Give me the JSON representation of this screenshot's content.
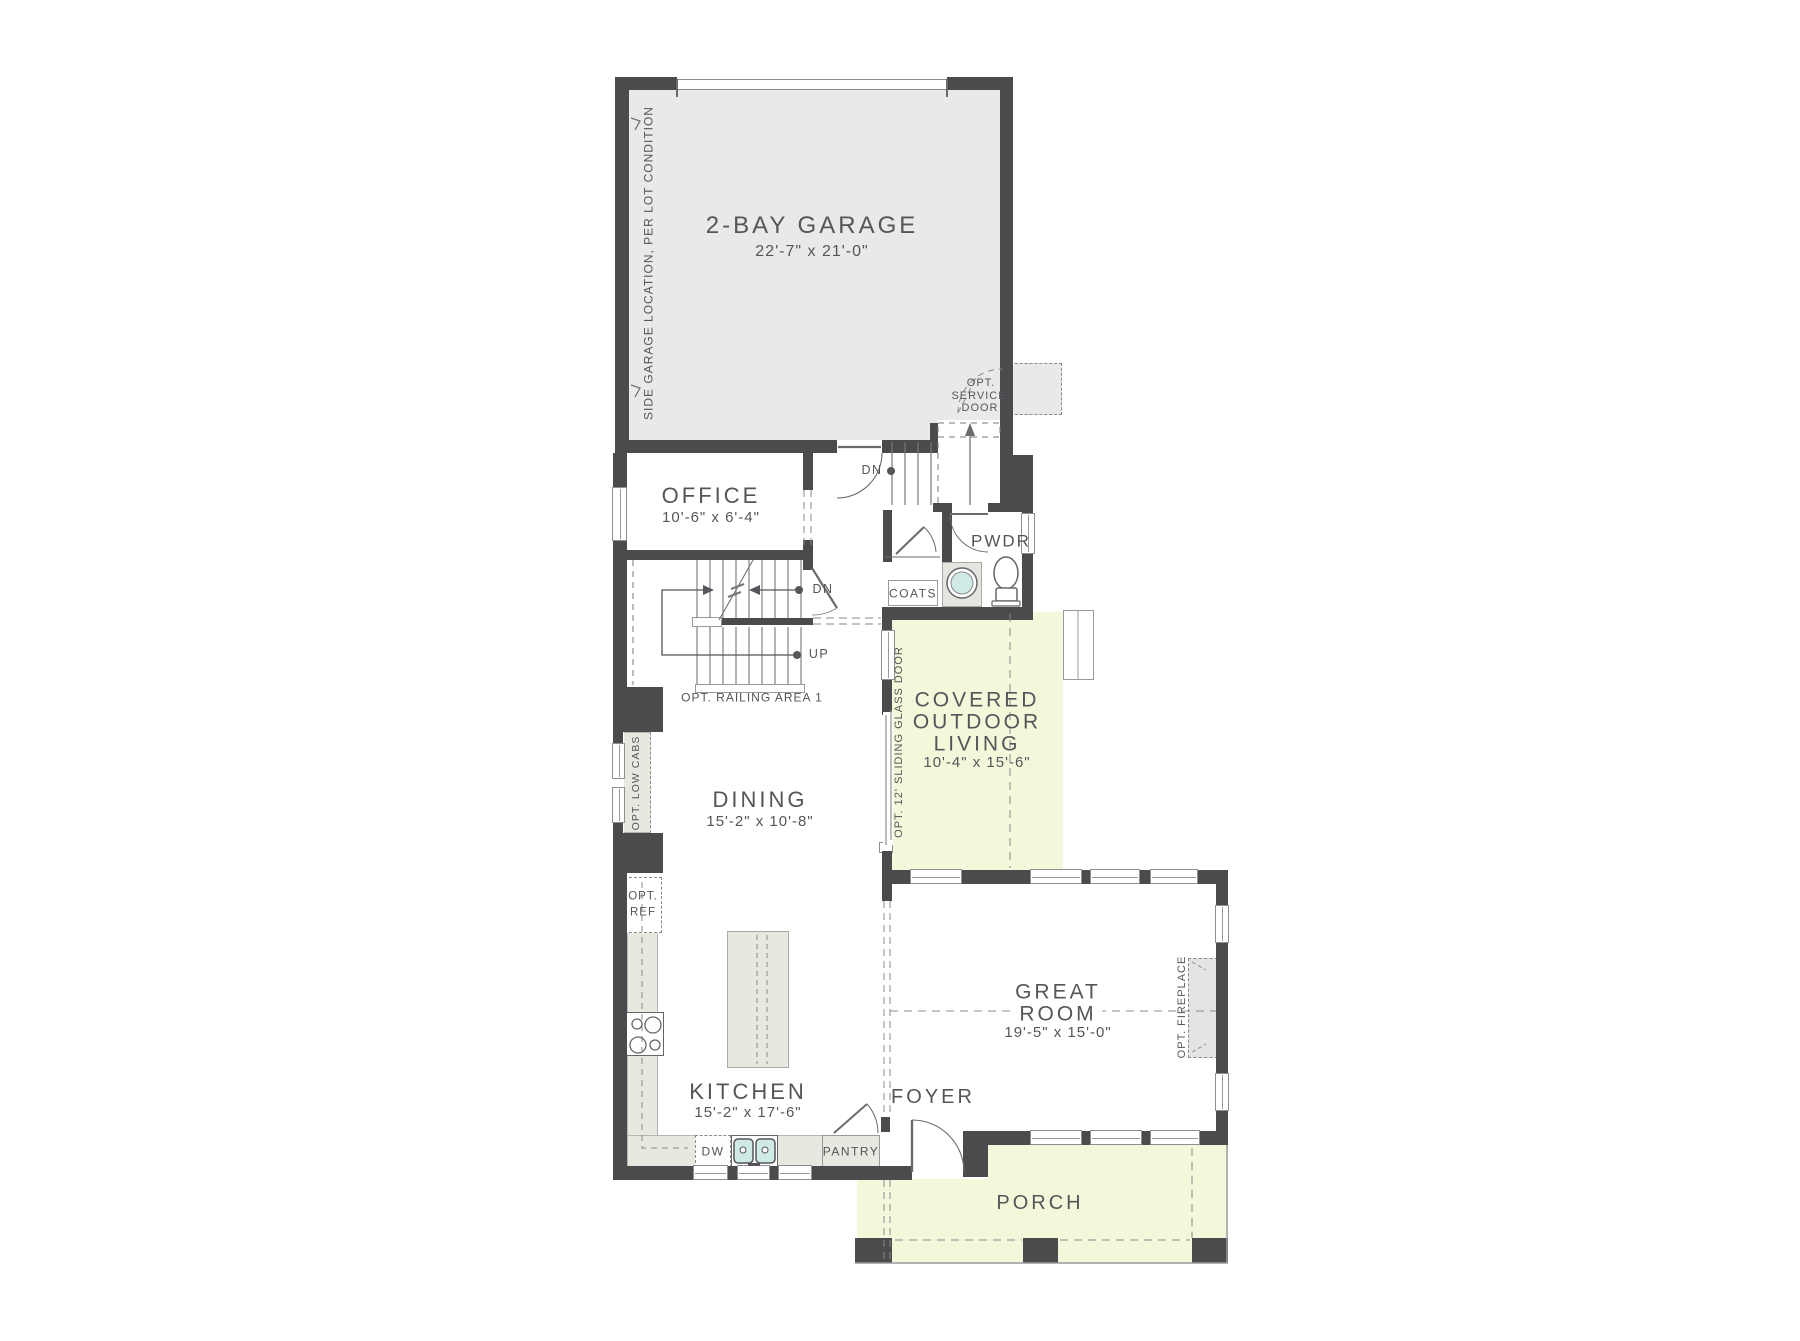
{
  "colors": {
    "wall": "#4b4b4d",
    "ink": "#55555a",
    "garage": "#e9e9e9",
    "outdoor": "#f5f7da",
    "counter": "#e8e7e0",
    "sink": "#cfe9e4",
    "fireplace": "#e4e4e4",
    "line": "#6b6b6e"
  },
  "rooms": {
    "garage": {
      "label": "2-BAY GARAGE",
      "dims": "22'-7\" x 21'-0\""
    },
    "office": {
      "label": "OFFICE",
      "dims": "10'-6\" x 6'-4\""
    },
    "dining": {
      "label": "DINING",
      "dims": "15'-2\" x 10'-8\""
    },
    "kitchen": {
      "label": "KITCHEN",
      "dims": "15'-2\" x 17'-6\""
    },
    "great_room": {
      "l1": "GREAT",
      "l2": "ROOM",
      "dims": "19'-5\" x 15'-0\""
    },
    "outdoor": {
      "l1": "COVERED",
      "l2": "OUTDOOR",
      "l3": "LIVING",
      "dims": "10'-4\" x 15'-6\""
    },
    "foyer": {
      "label": "FOYER"
    },
    "porch": {
      "label": "PORCH"
    },
    "pwdr": {
      "label": "PWDR"
    },
    "coats": {
      "label": "COATS"
    },
    "pantry": {
      "label": "PANTRY"
    }
  },
  "annotations": {
    "side_garage": "SIDE GARAGE LOCATION, PER LOT CONDITION",
    "opt_service_l1": "OPT.",
    "opt_service_l2": "SERVICE",
    "opt_service_l3": "DOOR",
    "opt_railing": "OPT. RAILING AREA 1",
    "opt_low_cabs": "OPT. LOW CABS",
    "opt_ref_l1": "OPT.",
    "opt_ref_l2": "REF",
    "opt_sliding": "OPT. 12' SLIDING GLASS DOOR",
    "opt_fireplace": "OPT. FIREPLACE",
    "dn": "DN",
    "up": "UP",
    "dw": "DW"
  }
}
